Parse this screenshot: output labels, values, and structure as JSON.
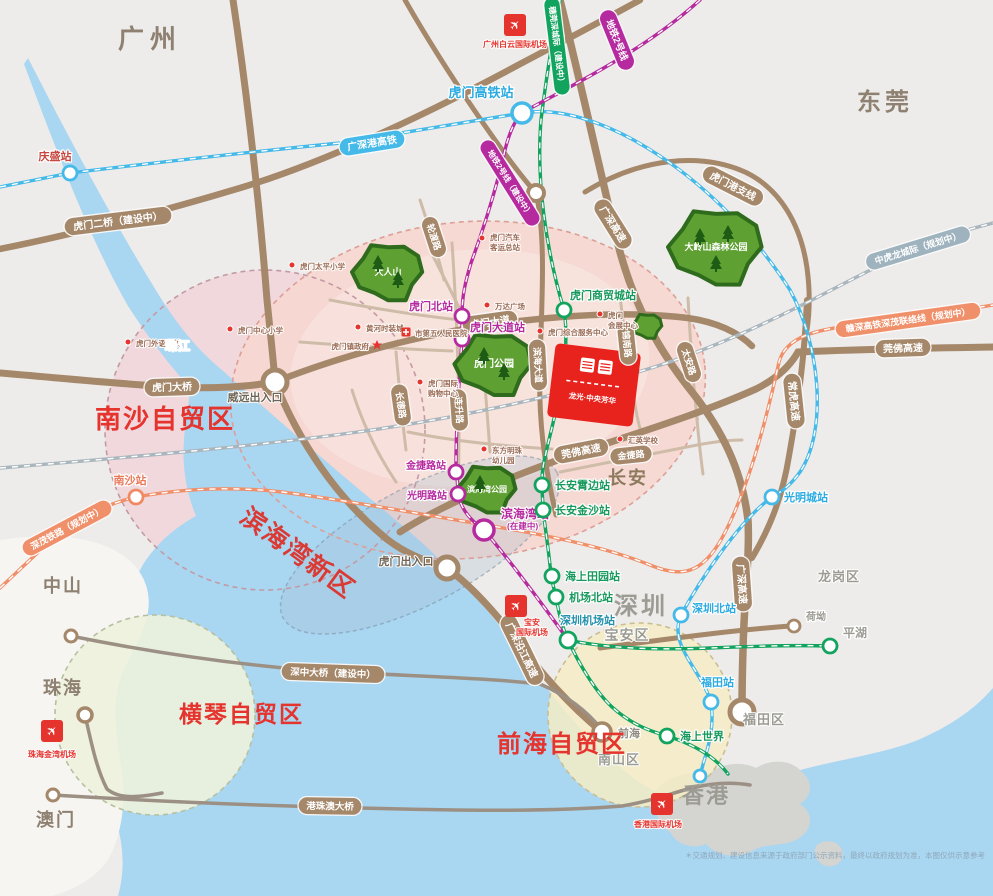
{
  "colors": {
    "brown": "#a5876a",
    "blue": "#45b9e8",
    "green": "#12a35f",
    "magenta": "#b62a9f",
    "orange": "#f0906b",
    "grayblue": "#9fb3be",
    "red": "#e5332d",
    "land": "#edecea",
    "water": "#a9d6f1",
    "pinkzone": "#f6d7d0"
  },
  "cities": [
    {
      "t": "广州",
      "x": 150,
      "y": 48,
      "fs": 26,
      "c": "#8e8171",
      "ls": 6
    },
    {
      "t": "东莞",
      "x": 885,
      "y": 110,
      "fs": 24,
      "c": "#8e8171",
      "ls": 4
    },
    {
      "t": "深圳",
      "x": 641,
      "y": 614,
      "fs": 24,
      "c": "#9c9c94",
      "ls": 3
    },
    {
      "t": "香港",
      "x": 706,
      "y": 803,
      "fs": 22,
      "c": "#9c9c94",
      "ls": 2
    },
    {
      "t": "中山",
      "x": 63,
      "y": 592,
      "fs": 18,
      "c": "#8e8171",
      "ls": 2
    },
    {
      "t": "珠海",
      "x": 63,
      "y": 694,
      "fs": 18,
      "c": "#8e8171",
      "ls": 2
    },
    {
      "t": "澳门",
      "x": 56,
      "y": 826,
      "fs": 18,
      "c": "#8e8171",
      "ls": 2
    },
    {
      "t": "长安",
      "x": 628,
      "y": 484,
      "fs": 18,
      "c": "#8d7a5c",
      "ls": 2
    },
    {
      "t": "宝安区",
      "x": 627,
      "y": 640,
      "fs": 14,
      "c": "#9c9c94",
      "ls": 1
    },
    {
      "t": "南山区",
      "x": 619,
      "y": 764,
      "fs": 13,
      "c": "#9c9c94",
      "ls": 1
    },
    {
      "t": "福田区",
      "x": 764,
      "y": 724,
      "fs": 13,
      "c": "#9c9c94",
      "ls": 1
    },
    {
      "t": "龙岗区",
      "x": 839,
      "y": 581,
      "fs": 13,
      "c": "#9c9c94",
      "ls": 1
    },
    {
      "t": "珠江",
      "x": 178,
      "y": 350,
      "fs": 12,
      "c": "#ffffff",
      "ls": 1
    },
    {
      "t": "威远出入口",
      "x": 255,
      "y": 401,
      "fs": 11,
      "c": "#6f6657",
      "ls": 0
    },
    {
      "t": "虎门出入口",
      "x": 406,
      "y": 565,
      "fs": 11,
      "c": "#6f6657",
      "ls": 0
    }
  ],
  "zones": [
    {
      "t": "南沙自贸区",
      "x": 95,
      "y": 428,
      "fs": 26,
      "c": "#e5332d",
      "rot": 0,
      "ls": 2
    },
    {
      "t": "滨海湾新区",
      "x": 293,
      "y": 560,
      "fs": 25,
      "c": "#da3a33",
      "rot": 36,
      "ls": 2
    },
    {
      "t": "横琴自贸区",
      "x": 179,
      "y": 722,
      "fs": 23,
      "c": "#e5332d",
      "rot": 0,
      "ls": 2
    },
    {
      "t": "前海自贸区",
      "x": 497,
      "y": 752,
      "fs": 24,
      "c": "#e5332d",
      "rot": 0,
      "ls": 2
    }
  ],
  "badges": [
    {
      "t": "广深港高铁",
      "x": 372,
      "y": 143,
      "rot": -9,
      "bg": "blue",
      "fs": 10
    },
    {
      "t": "穗莞深城际（建设中）",
      "x": 557,
      "y": 46,
      "rot": 83,
      "bg": "green",
      "fs": 8
    },
    {
      "t": "地铁2号线",
      "x": 617,
      "y": 40,
      "rot": 68,
      "bg": "magenta",
      "fs": 9.5
    },
    {
      "t": "地铁2号线（建设中）",
      "x": 510,
      "y": 183,
      "rot": 58,
      "bg": "magenta",
      "fs": 8
    },
    {
      "t": "虎门二桥（建设中）",
      "x": 118,
      "y": 221,
      "rot": -7,
      "bg": "brown",
      "fs": 10
    },
    {
      "t": "虎门大桥",
      "x": 172,
      "y": 387,
      "rot": -2,
      "bg": "brown",
      "fs": 10
    },
    {
      "t": "轮渡路",
      "x": 434,
      "y": 237,
      "rot": 72,
      "bg": "brown",
      "fs": 9
    },
    {
      "t": "虎门大道",
      "x": 490,
      "y": 322,
      "rot": -8,
      "bg": "brown",
      "fs": 10
    },
    {
      "t": "滨海大道",
      "x": 538,
      "y": 365,
      "rot": 87,
      "bg": "brown",
      "fs": 9
    },
    {
      "t": "连升路",
      "x": 459,
      "y": 410,
      "rot": 86,
      "bg": "brown",
      "fs": 9
    },
    {
      "t": "长德路",
      "x": 401,
      "y": 405,
      "rot": 82,
      "bg": "brown",
      "fs": 9
    },
    {
      "t": "锦南路",
      "x": 627,
      "y": 344,
      "rot": 84,
      "bg": "brown",
      "fs": 9
    },
    {
      "t": "太安路",
      "x": 689,
      "y": 362,
      "rot": 72,
      "bg": "brown",
      "fs": 9
    },
    {
      "t": "金捷路",
      "x": 631,
      "y": 455,
      "rot": -6,
      "bg": "brown",
      "fs": 9
    },
    {
      "t": "莞佛高速",
      "x": 581,
      "y": 451,
      "rot": -11,
      "bg": "brown",
      "fs": 10
    },
    {
      "t": "莞佛高速",
      "x": 903,
      "y": 348,
      "rot": -2,
      "bg": "brown",
      "fs": 10
    },
    {
      "t": "常虎高速",
      "x": 794,
      "y": 401,
      "rot": 84,
      "bg": "brown",
      "fs": 10
    },
    {
      "t": "广深高速",
      "x": 613,
      "y": 224,
      "rot": 58,
      "bg": "brown",
      "fs": 10
    },
    {
      "t": "广深高速",
      "x": 742,
      "y": 584,
      "rot": 86,
      "bg": "brown",
      "fs": 10
    },
    {
      "t": "虎门港支线",
      "x": 733,
      "y": 186,
      "rot": 27,
      "bg": "brown",
      "fs": 10
    },
    {
      "t": "广深沿江高速",
      "x": 522,
      "y": 650,
      "rot": 64,
      "bg": "brown",
      "fs": 10
    },
    {
      "t": "深中大桥（建设中）",
      "x": 333,
      "y": 673,
      "rot": 2,
      "bg": "brown",
      "fs": 9.5
    },
    {
      "t": "港珠澳大桥",
      "x": 330,
      "y": 806,
      "rot": 1,
      "bg": "brown",
      "fs": 9.5
    },
    {
      "t": "深茂铁路（规划中）",
      "x": 67,
      "y": 528,
      "rot": -28,
      "bg": "orange",
      "fs": 9
    },
    {
      "t": "赣深高铁深茂联络线（规划中）",
      "x": 908,
      "y": 320,
      "rot": -8,
      "bg": "orange",
      "fs": 9
    },
    {
      "t": "中虎龙城际（规划中）",
      "x": 918,
      "y": 248,
      "rot": -17,
      "bg": "grayblue",
      "fs": 9
    }
  ],
  "stations": [
    {
      "t": "庆盛站",
      "cx": 70,
      "cy": 173,
      "r": 7,
      "ring": "blue",
      "lx": 55,
      "ly": 160,
      "anchor": "middle",
      "lc": "#c8463f",
      "fs": 11,
      "sub": ""
    },
    {
      "t": "虎门高铁站",
      "cx": 522,
      "cy": 113,
      "r": 10,
      "ring": "blue",
      "lx": 481,
      "ly": 97,
      "anchor": "middle",
      "lc": "#2babe2",
      "fs": 13,
      "sub": ""
    },
    {
      "t": "光明城站",
      "cx": 772,
      "cy": 497,
      "r": 7,
      "ring": "blue",
      "lx": 784,
      "ly": 501,
      "anchor": "start",
      "lc": "#2babe2",
      "fs": 11,
      "sub": ""
    },
    {
      "t": "深圳北站",
      "cx": 681,
      "cy": 615,
      "r": 7,
      "ring": "blue",
      "lx": 692,
      "ly": 612,
      "anchor": "start",
      "lc": "#2babe2",
      "fs": 11,
      "sub": ""
    },
    {
      "t": "福田站",
      "cx": 711,
      "cy": 702,
      "r": 7,
      "ring": "blue",
      "lx": 701,
      "ly": 686,
      "anchor": "start",
      "lc": "#2babe2",
      "fs": 11,
      "sub": ""
    },
    {
      "t": "",
      "cx": 700,
      "cy": 776,
      "r": 6,
      "ring": "blue",
      "lx": 0,
      "ly": 0,
      "anchor": "start",
      "lc": "#2babe2",
      "fs": 10,
      "sub": ""
    },
    {
      "t": "虎门北站",
      "cx": 462,
      "cy": 316,
      "r": 7,
      "ring": "magenta",
      "lx": 453,
      "ly": 310,
      "anchor": "end",
      "lc": "#b62a9f",
      "fs": 11,
      "sub": ""
    },
    {
      "t": "虎门大道站",
      "cx": 462,
      "cy": 339,
      "r": 7,
      "ring": "magenta",
      "lx": 470,
      "ly": 331,
      "anchor": "start",
      "lc": "#b62a9f",
      "fs": 11,
      "sub": ""
    },
    {
      "t": "金捷路站",
      "cx": 456,
      "cy": 472,
      "r": 7,
      "ring": "magenta",
      "lx": 446,
      "ly": 469,
      "anchor": "end",
      "lc": "#b62a9f",
      "fs": 10,
      "sub": ""
    },
    {
      "t": "光明路站",
      "cx": 458,
      "cy": 494,
      "r": 7,
      "ring": "magenta",
      "lx": 447,
      "ly": 499,
      "anchor": "end",
      "lc": "#b62a9f",
      "fs": 10,
      "sub": ""
    },
    {
      "t": "滨海湾站",
      "cx": 484,
      "cy": 530,
      "r": 10,
      "ring": "magenta",
      "lx": 501,
      "ly": 518,
      "anchor": "start",
      "lc": "#b62a9f",
      "fs": 12,
      "sub": "(在建中)"
    },
    {
      "t": "深圳机场站",
      "cx": 568,
      "cy": 640,
      "r": 8,
      "ring": "green",
      "lx": 560,
      "ly": 624,
      "anchor": "start",
      "lc": "#2491ad",
      "fs": 11,
      "sub": ""
    },
    {
      "t": "机场北站",
      "cx": 556,
      "cy": 597,
      "r": 7,
      "ring": "green",
      "lx": 569,
      "ly": 601,
      "anchor": "start",
      "lc": "#17995c",
      "fs": 11,
      "sub": ""
    },
    {
      "t": "海上田园站",
      "cx": 552,
      "cy": 576,
      "r": 7,
      "ring": "green",
      "lx": 565,
      "ly": 580,
      "anchor": "start",
      "lc": "#17995c",
      "fs": 11,
      "sub": ""
    },
    {
      "t": "长安霄边站",
      "cx": 542,
      "cy": 485,
      "r": 7,
      "ring": "green",
      "lx": 555,
      "ly": 489,
      "anchor": "start",
      "lc": "#17995c",
      "fs": 11,
      "sub": ""
    },
    {
      "t": "长安金沙站",
      "cx": 543,
      "cy": 510,
      "r": 7,
      "ring": "green",
      "lx": 555,
      "ly": 514,
      "anchor": "start",
      "lc": "#17995c",
      "fs": 11,
      "sub": ""
    },
    {
      "t": "虎门商贸城站",
      "cx": 564,
      "cy": 310,
      "r": 7,
      "ring": "green",
      "lx": 570,
      "ly": 299,
      "anchor": "start",
      "lc": "#17995c",
      "fs": 11,
      "sub": ""
    },
    {
      "t": "海上世界",
      "cx": 667,
      "cy": 736,
      "r": 7,
      "ring": "green",
      "lx": 680,
      "ly": 740,
      "anchor": "start",
      "lc": "#17995c",
      "fs": 11,
      "sub": ""
    },
    {
      "t": "平湖",
      "cx": 830,
      "cy": 646,
      "r": 7,
      "ring": "green",
      "lx": 843,
      "ly": 637,
      "anchor": "start",
      "lc": "#9c9c94",
      "fs": 12,
      "sub": ""
    },
    {
      "t": "南沙站",
      "cx": 136,
      "cy": 497,
      "r": 7,
      "ring": "orange",
      "lx": 130,
      "ly": 484,
      "anchor": "middle",
      "lc": "#e87a5a",
      "fs": 11,
      "sub": ""
    },
    {
      "t": "前海",
      "cx": 602,
      "cy": 732,
      "r": 9,
      "ring": "brown",
      "lx": 618,
      "ly": 737,
      "anchor": "start",
      "lc": "#8f8b80",
      "fs": 11,
      "sub": ""
    },
    {
      "t": "荷坳",
      "cx": 794,
      "cy": 626,
      "r": 6,
      "ring": "brown",
      "lx": 806,
      "ly": 620,
      "anchor": "start",
      "lc": "#9c9c94",
      "fs": 10,
      "sub": ""
    }
  ],
  "parks": [
    {
      "t": "大人山",
      "x": 388,
      "y": 272,
      "r": 30,
      "fs": 9
    },
    {
      "t": "大岭山森林公园",
      "x": 716,
      "y": 247,
      "r": 40,
      "fs": 9
    },
    {
      "t": "虎门公园",
      "x": 494,
      "y": 364,
      "r": 33,
      "fs": 10
    },
    {
      "t": "滨海湾公园",
      "x": 487,
      "y": 489,
      "r": 25,
      "fs": 8
    }
  ],
  "airports": [
    {
      "lines": [
        "广州白云国际机场"
      ],
      "x": 515,
      "y": 25,
      "tx": 515,
      "ty": 47
    },
    {
      "lines": [
        "宝安",
        "国际机场"
      ],
      "x": 516,
      "y": 606,
      "tx": 532,
      "ty": 625
    },
    {
      "lines": [
        "珠海金湾机场"
      ],
      "x": 52,
      "y": 731,
      "tx": 52,
      "ty": 757
    },
    {
      "lines": [
        "香港国际机场"
      ],
      "x": 662,
      "y": 804,
      "tx": 658,
      "ty": 827
    }
  ],
  "pois": [
    {
      "icon": "dot",
      "lines": [
        "虎门太平小学"
      ],
      "ix": 292,
      "iy": 265,
      "tx": 300,
      "ty": 269,
      "anchor": "start"
    },
    {
      "icon": "dot",
      "lines": [
        "虎门外语学校"
      ],
      "ix": 128,
      "iy": 342,
      "tx": 136,
      "ty": 346,
      "anchor": "start"
    },
    {
      "icon": "dot",
      "lines": [
        "虎门中心小学"
      ],
      "ix": 230,
      "iy": 329,
      "tx": 238,
      "ty": 333,
      "anchor": "start"
    },
    {
      "icon": "dot",
      "lines": [
        "黄河时装城"
      ],
      "ix": 358,
      "iy": 327,
      "tx": 366,
      "ty": 331,
      "anchor": "start"
    },
    {
      "icon": "star",
      "lines": [
        "虎门镇政府"
      ],
      "ix": 377,
      "iy": 345,
      "tx": 369,
      "ty": 349,
      "anchor": "end"
    },
    {
      "icon": "dot",
      "lines": [
        "虎门汽车",
        "客运总站"
      ],
      "ix": 482,
      "iy": 238,
      "tx": 490,
      "ty": 240,
      "anchor": "start"
    },
    {
      "icon": "dot",
      "lines": [
        "万达广场"
      ],
      "ix": 487,
      "iy": 305,
      "tx": 495,
      "ty": 309,
      "anchor": "start"
    },
    {
      "icon": "cross",
      "lines": [
        "市第五人民医院"
      ],
      "ix": 406,
      "iy": 332,
      "tx": 415,
      "ty": 336,
      "anchor": "start"
    },
    {
      "icon": "dot",
      "lines": [
        "虎门",
        "会展中心"
      ],
      "ix": 600,
      "iy": 314,
      "tx": 608,
      "ty": 318,
      "anchor": "start"
    },
    {
      "icon": "dot",
      "lines": [
        "虎门综合服务中心"
      ],
      "ix": 540,
      "iy": 331,
      "tx": 548,
      "ty": 335,
      "anchor": "start"
    },
    {
      "icon": "dot",
      "lines": [
        "虎门国际",
        "购物中心"
      ],
      "ix": 420,
      "iy": 382,
      "tx": 428,
      "ty": 386,
      "anchor": "start"
    },
    {
      "icon": "dot",
      "lines": [
        "东方明珠",
        "幼儿园"
      ],
      "ix": 484,
      "iy": 449,
      "tx": 492,
      "ty": 453,
      "anchor": "start"
    },
    {
      "icon": "dot",
      "lines": [
        "汇英学校"
      ],
      "ix": 620,
      "iy": 439,
      "tx": 628,
      "ty": 443,
      "anchor": "start"
    }
  ],
  "project": {
    "name": "龙光·中央芳华"
  },
  "disclaimer": {
    "t": "＊交通规划、建设信息来源于政府部门公示资料，最终以政府规划为准，本图仅供示意参考",
    "x": 985,
    "y": 858
  }
}
